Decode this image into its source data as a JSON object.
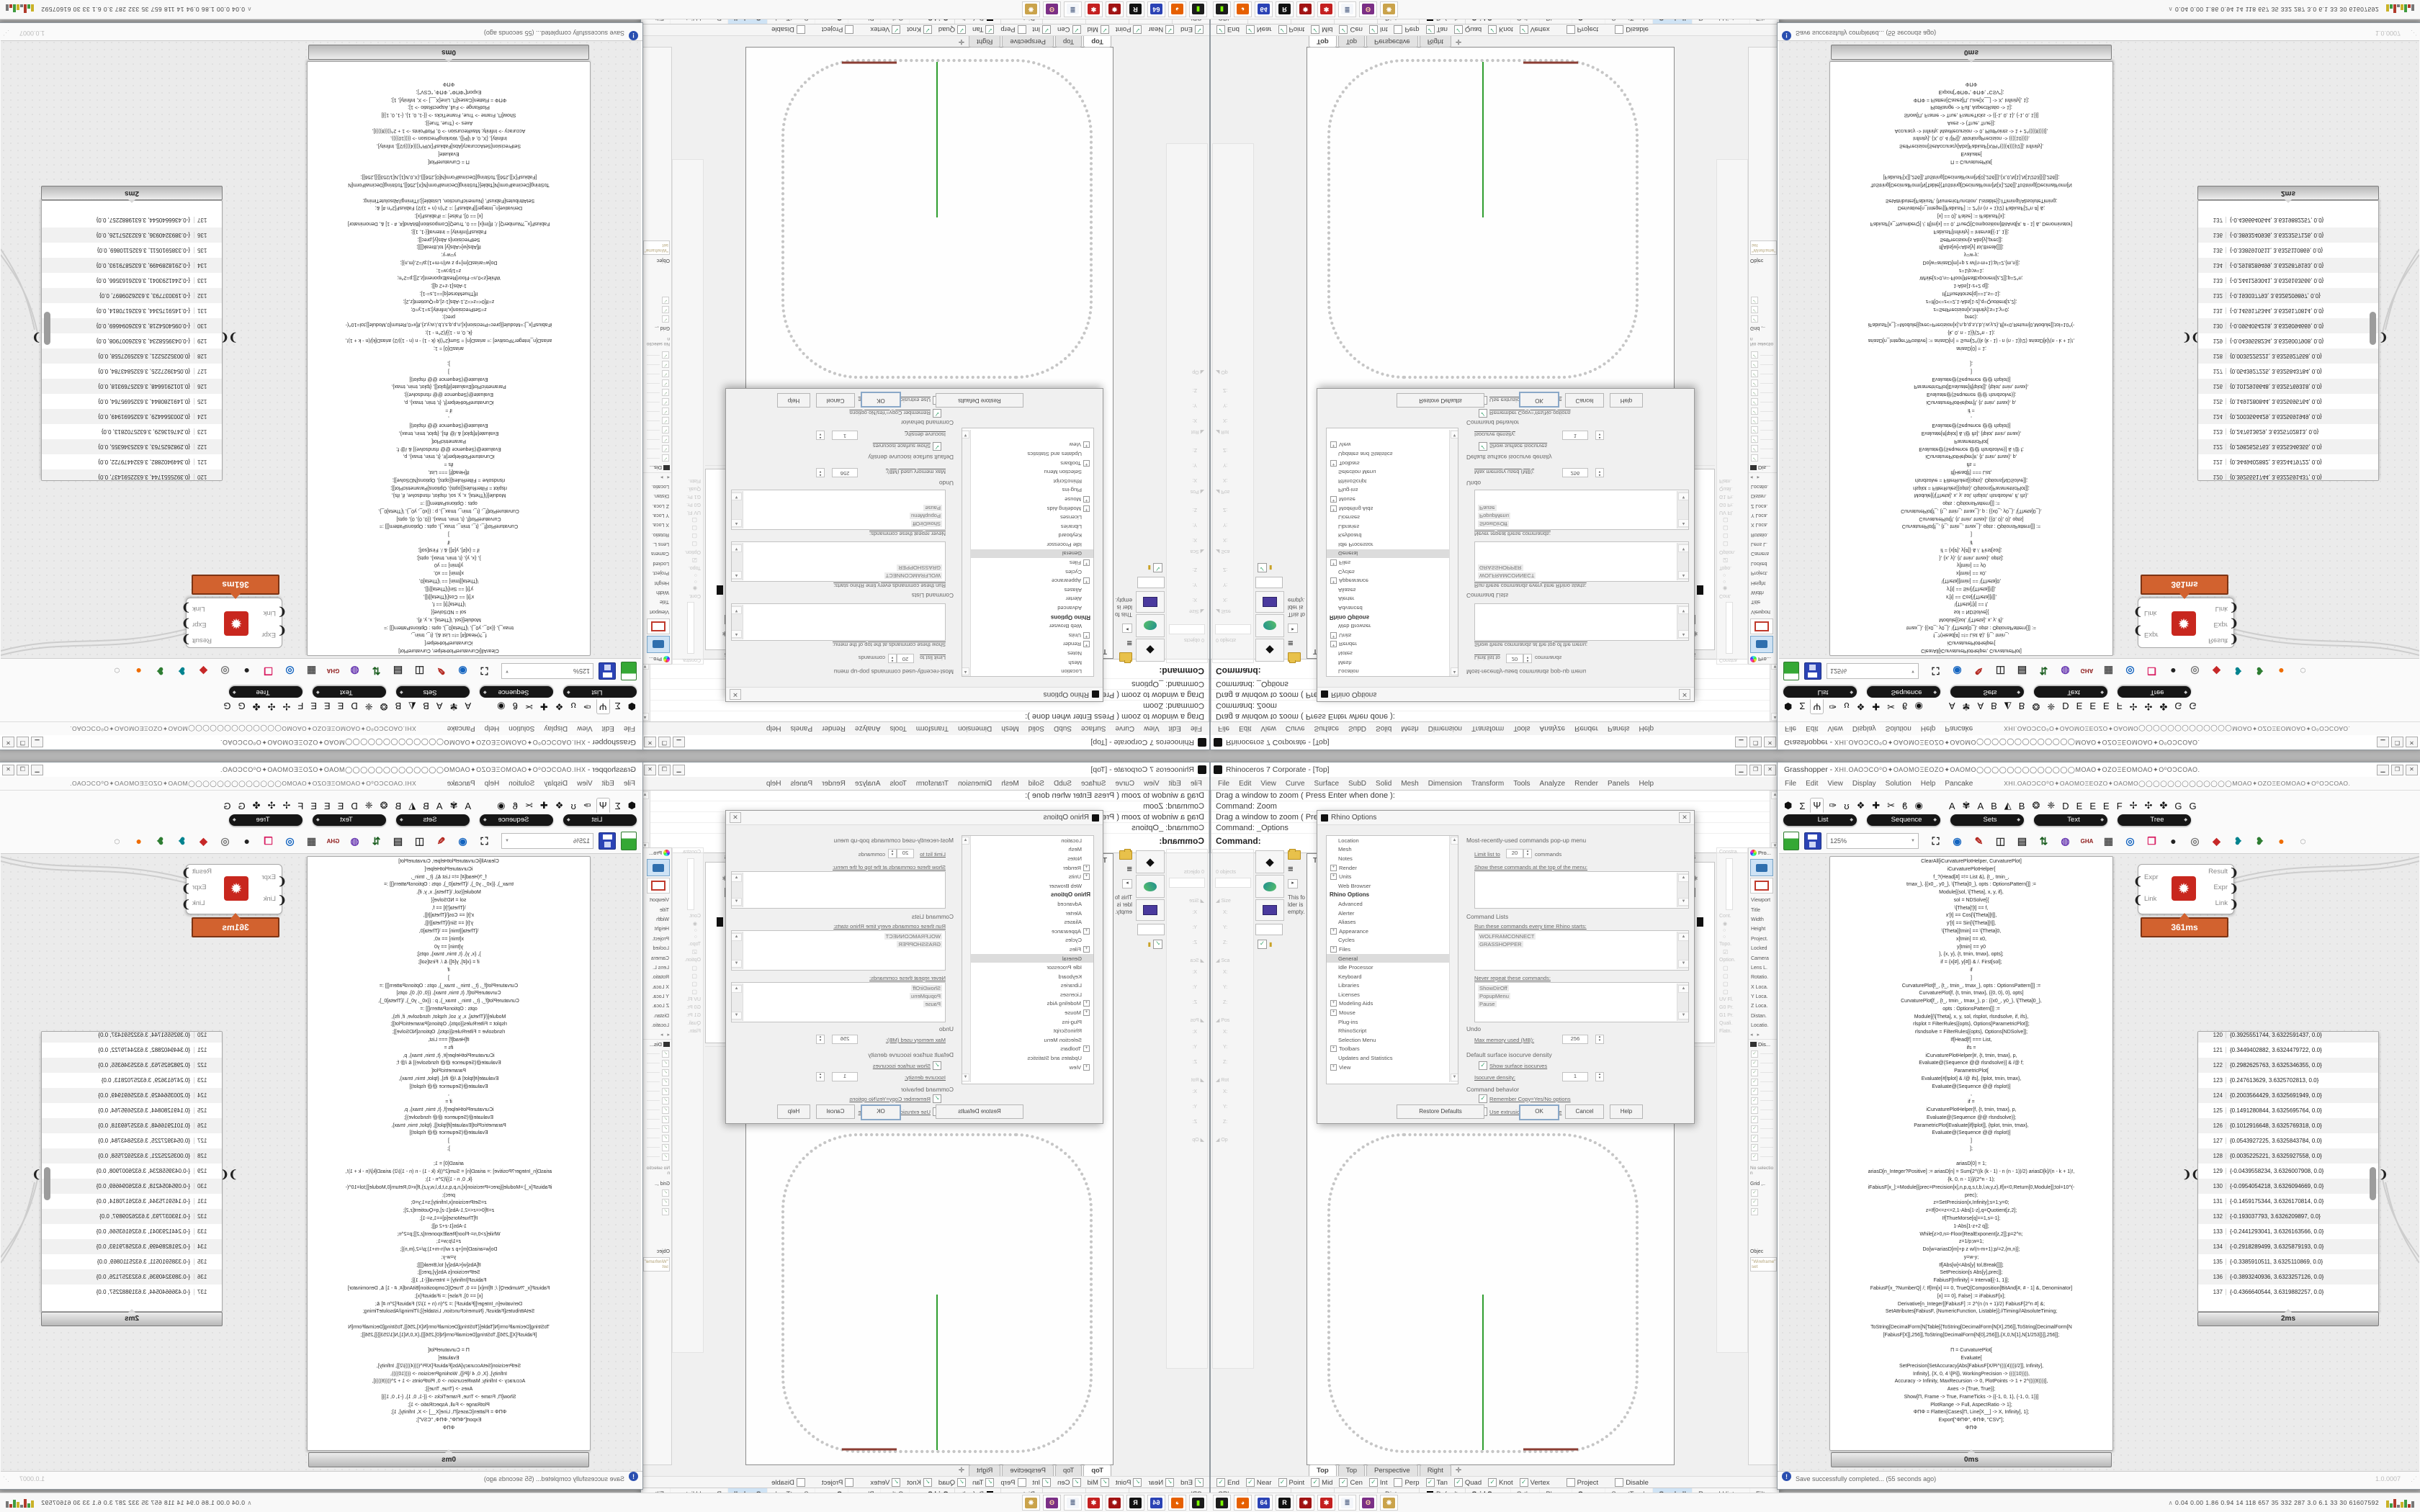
{
  "rhino": {
    "title": "Rhinoceros 7 Corporate - [Top]",
    "window_buttons": [
      "▁",
      "❐",
      "✕"
    ],
    "menu": [
      "File",
      "Edit",
      "View",
      "Curve",
      "Surface",
      "SubD",
      "Solid",
      "Mesh",
      "Dimension",
      "Transform",
      "Tools",
      "Analyze",
      "Render",
      "Panels",
      "Help"
    ],
    "command_lines": [
      "Drag a window to zoom ( Press Enter when done ):",
      "Command: Zoom",
      "Drag a window to zoom ( Press Enter when done ):",
      "Command: _Options"
    ],
    "prompt": "Command:",
    "viewport": {
      "label": "Top",
      "tabs": [
        "Top",
        "Top",
        "Perspective",
        "Right"
      ],
      "active": 0,
      "new_tab": "✛"
    },
    "osnap": [
      {
        "l": "End",
        "c": 1
      },
      {
        "l": "Near",
        "c": 1
      },
      {
        "l": "Point",
        "c": 1
      },
      {
        "l": "Mid",
        "c": 1
      },
      {
        "l": "Cen",
        "c": 1
      },
      {
        "l": "Int",
        "c": 1
      },
      {
        "l": "Perp",
        "c": 0
      },
      {
        "l": "Tan",
        "c": 1
      },
      {
        "l": "Quad",
        "c": 1
      },
      {
        "l": "Knot",
        "c": 1
      },
      {
        "l": "Vertex",
        "c": 1
      },
      {
        "l": "Project",
        "c": 0
      },
      {
        "l": "Disable",
        "c": 0
      }
    ],
    "status_fields": [
      "CPlane",
      "x",
      "y",
      "z",
      "Distance"
    ],
    "default_swatch": "Default",
    "toggles": [
      {
        "l": "Grid Snap",
        "b": 1
      },
      {
        "l": "Ortho"
      },
      {
        "l": "Planar"
      },
      {
        "l": "Osnap",
        "b": 1
      },
      {
        "l": "SmartTrack"
      },
      {
        "l": "Gumball",
        "hl": 1
      },
      {
        "l": "Record History"
      },
      {
        "l": "Filter"
      }
    ],
    "sidebar": {
      "objects": "0 objects",
      "notes": "This folder is empty.",
      "boxedit_sections": [
        "Size",
        "Sca",
        "Pos",
        "Rot"
      ],
      "axis": [
        "X:",
        "Y:",
        "Z:"
      ],
      "more": "Op"
    },
    "dock": {
      "layers_title": "Layers",
      "rcp": "RCP",
      "props_title": "Pro...",
      "display_title": "Dis...",
      "props_rows": [
        "Viewport",
        "Title",
        "Width",
        "Height",
        "Project.",
        "Locked",
        "Camera",
        "Lens L.",
        "Rotatio.",
        "X Loca.",
        "Y Loca.",
        "Z Loca.",
        "Distan.",
        "Locatio."
      ],
      "display_checks": 12,
      "no_selection": "No selectio n",
      "grid_label": "Grid ,..",
      "object_label": "Objec",
      "wireframe": "\"Wireframe\" set",
      "ghost_labels": [
        "Constra.",
        "Cont.",
        "Topo.",
        "Option.",
        "UV Fl.",
        "G0 Pr.",
        "G1 Pr.",
        "Quali.",
        "Flatn."
      ],
      "materials_note": "no materia l in this model. Click the [+] button"
    },
    "options": {
      "title": "Rhino Options",
      "tree": [
        {
          "l": "Location"
        },
        {
          "l": "Mesh"
        },
        {
          "l": "Notes"
        },
        {
          "l": "Render",
          "p": 1
        },
        {
          "l": "Units",
          "p": 1
        },
        {
          "l": "Web Browser"
        },
        {
          "l": "Rhino Options",
          "h": 1
        },
        {
          "l": "Advanced"
        },
        {
          "l": "Alerter"
        },
        {
          "l": "Aliases"
        },
        {
          "l": "Appearance",
          "p": 1
        },
        {
          "l": "Cycles"
        },
        {
          "l": "Files",
          "p": 1
        },
        {
          "l": "General",
          "s": 1
        },
        {
          "l": "Idle Processor"
        },
        {
          "l": "Keyboard"
        },
        {
          "l": "Libraries"
        },
        {
          "l": "Licenses"
        },
        {
          "l": "Modeling Aids",
          "p": 1
        },
        {
          "l": "Mouse",
          "p": 1
        },
        {
          "l": "Plug-ins"
        },
        {
          "l": "RhinoScript"
        },
        {
          "l": "Selection Menu"
        },
        {
          "l": "Toolbars",
          "p": 1
        },
        {
          "l": "Updates and Statistics"
        },
        {
          "l": "View",
          "p": 1
        }
      ],
      "mru_title": "Most-recently-used commands pop-up menu",
      "limit_pre": "Limit list to",
      "limit_value": "20",
      "limit_post": "commands",
      "show_top": "Show these commands at the top of the menu:",
      "cmd_lists_title": "Command Lists",
      "run_label": "Run these commands every time Rhino starts:",
      "run_items": [
        "WOLFRAMCONNECT",
        "GRASSHOPPER"
      ],
      "never_label": "Never repeat these commands:",
      "never_items": [
        "ShowDirOff",
        "PopupMenu",
        "Pause"
      ],
      "undo_title": "Undo",
      "mem_label": "Max memory used (MB):",
      "mem_value": "256",
      "iso_title": "Default surface isocurve density",
      "iso_check": "Show surface isocurves",
      "iso_density_label": "Isocurve density:",
      "iso_density_value": "1",
      "behavior_title": "Command behavior",
      "behavior_items": [
        "Remember Copy=Yes/No options",
        "Use extrusions when possible"
      ],
      "buttons": [
        "Restore Defaults",
        "OK",
        "Cancel",
        "Help"
      ]
    }
  },
  "gh": {
    "title_prefix": "Grasshopper - ",
    "title_symbols": "ΧΗΙ.ΟΑΟϽCΟ⁰Ο✦ΟΑΟΜΟΞΕΟΖΟ✦ΟΑΟΜΟ◯◯◯◯◯◯◯◯◯◯◯◯◯ΜΟΑΟ✦ΟΖΟΞΕΟΜΟΑΟ✦Ο⁰ΟϽCΟΑΟ.",
    "window_buttons": [
      "▁",
      "❐",
      "✕"
    ],
    "menu": [
      "File",
      "Edit",
      "View",
      "Display",
      "Solution",
      "Help",
      "Pancake"
    ],
    "tab_glyphs": [
      "⬢",
      "Σ",
      "Ψ",
      "✑",
      "ʊ",
      "❖",
      "✚",
      "✂",
      "ϐ",
      "◉",
      "A",
      "✾",
      "A",
      "B",
      "◭",
      "B",
      "❂",
      "❈",
      "D",
      "E",
      "E",
      "E",
      "F",
      "✢",
      "✣",
      "✤",
      "G",
      "G"
    ],
    "selected_tab": 2,
    "pills": [
      "List",
      "Sequence",
      "Sets",
      "Text",
      "Tree"
    ],
    "zoom": "125%",
    "toolbar": [
      {
        "g": "⛶",
        "c": "#111"
      },
      {
        "g": "◉",
        "c": "#1565c0"
      },
      {
        "g": "✎",
        "c": "#b3261e"
      },
      {
        "g": "◫",
        "c": "#333"
      },
      {
        "g": "▤",
        "c": "#333"
      },
      {
        "g": "⇅",
        "c": "#1b5e20"
      },
      {
        "g": "◍",
        "c": "#6a3ab2"
      },
      {
        "g": "GHA",
        "c": "#8e1b1b"
      },
      {
        "g": "▦",
        "c": "#555"
      },
      {
        "g": "◎",
        "c": "#1565c0"
      },
      {
        "g": "❒",
        "c": "#d81b60"
      },
      {
        "g": "●",
        "c": "#222"
      },
      {
        "g": "◎",
        "c": "#777"
      },
      {
        "g": "◆",
        "c": "#c62828"
      },
      {
        "g": "❥",
        "c": "#00838f"
      },
      {
        "g": "❥",
        "c": "#2e7d32"
      },
      {
        "g": "●",
        "c": "#ef6c00"
      },
      {
        "g": "◌",
        "c": "#555"
      }
    ],
    "component": {
      "inputs": [
        "Expr",
        "Link"
      ],
      "outputs": [
        "Result",
        "Expr",
        "Link"
      ],
      "time": "361ms"
    },
    "code_time": "0ms",
    "list": {
      "time": "2ms",
      "items": [
        [
          120,
          "{0.3925551744, 3.6322591437, 0.0}"
        ],
        [
          121,
          "{0.3449402882, 3.6324479722, 0.0}"
        ],
        [
          122,
          "{0.2982625763, 3.6325346355, 0.0}"
        ],
        [
          123,
          "{0.247613629, 3.6325702813, 0.0}"
        ],
        [
          124,
          "{0.2003564429, 3.6325691949, 0.0}"
        ],
        [
          125,
          "{0.1491280844, 3.6325695764, 0.0}"
        ],
        [
          126,
          "{0.1012916648, 3.6325769318, 0.0}"
        ],
        [
          127,
          "{0.0543927225, 3.6325843784, 0.0}"
        ],
        [
          128,
          "{0.0035225221, 3.6325927558, 0.0}"
        ],
        [
          129,
          "{-0.0439558234, 3.6326007908, 0.0}"
        ],
        [
          130,
          "{-0.0954054218, 3.6326094669, 0.0}"
        ],
        [
          131,
          "{-0.1459175344, 3.6326170814, 0.0}"
        ],
        [
          132,
          "{-0.193037793, 3.6326209897, 0.0}"
        ],
        [
          133,
          "{-0.2441293041, 3.6326163566, 0.0}"
        ],
        [
          134,
          "{-0.2918289499, 3.6325879193, 0.0}"
        ],
        [
          135,
          "{-0.3385910511, 3.6325110869, 0.0}"
        ],
        [
          136,
          "{-0.3893240936, 3.6323257126, 0.0}"
        ],
        [
          137,
          "{-0.4366640544, 3.6319882257, 0.0}"
        ]
      ]
    },
    "status": {
      "msg": "Save successfully completed... (55 seconds ago)",
      "version": "1.0.0007"
    },
    "code_lines": [
      "ClearAll[iCurvaturePlotHelper, CurvaturePlot]",
      "iCurvaturePlotHelper[",
      "f_?(Head[#] =!= List &), {t_, tmin_,",
      "tmax_}, {{x0_, y0_}, \\[Theta]0_}, opts : OptionsPattern[]] :=",
      "Module[{sol, \\[Theta], x, y, if},",
      "sol = NDSolve[{",
      "\\[Theta]'[t] == f,",
      "x'[t] == Cos[\\[Theta][t]],",
      "y'[t] == Sin[\\[Theta][t]],",
      "\\[Theta][tmin] == \\[Theta]0,",
      "x[tmin] == x0,",
      "y[tmin] == y0",
      "}, {x, y}, {t, tmin, tmax}, opts];",
      "if = {x[#], y[#]} & /. First[sol];",
      "if",
      "]",
      "CurvaturePlot[f_, {t_, tmin_, tmax_}, opts : OptionsPattern[]] :=",
      "CurvaturePlot[f, {t, tmin, tmax}, {{0, 0}, 0}, opts]",
      "CurvaturePlot[f_, {t_, tmin_, tmax_}, p : {{x0_, y0_}, \\[Theta]0_},",
      "opts : OptionsPattern[]] :=",
      "Module[{\\[Theta], x, y, sol, rlsplot, rlsndsolve, if, ifs},",
      "rlsplot = FilterRules[{opts}, Options[ParametricPlot]];",
      "rlsndsolve = FilterRules[{opts}, Options[NDSolve]];",
      "If[Head[f] === List,",
      "ifs =",
      "iCurvaturePlotHelper[#, {t, tmin, tmax}, p,",
      "Evaluate@(Sequence @@ rlsndsolve)] & /@ f;",
      "ParametricPlot[",
      "Evaluate[#[tplot] & /@ ifs], {tplot, tmin, tmax},",
      "Evaluate@(Sequence @@ rlsplot)]",
      ",",
      "if =",
      "iCurvaturePlotHelper[f, {t, tmin, tmax}, p,",
      "Evaluate@(Sequence @@ rlsndsolve)];",
      "ParametricPlot[Evaluate[if[tplot]], {tplot, tmin, tmax},",
      "Evaluate@(Sequence @@ rlsplot)]",
      "]",
      "];",
      "",
      "ariasD[0] = 1;",
      "ariasD[n_Integer?Positive] := ariasD[n] = Sum[2^((k (k - 1) - n (n - 1))/2) ariasD[k]/(n - k + 1)!,",
      "{k, 0, n - 1}]/(2^n - 1);",
      "iFabiusF[x_]:=Module[{prec=Precision[x],n,p,q,s,t,b,l,w,y,z},If[x<0,Return[0,Module]];tol=10^(-",
      "prec);",
      "z=SetPrecision[x,Infinity];s=1;y=0;",
      "z=If[0<=z<=2,1-Abs[1-z],q=Quotient[z,2];",
      "If[ThueMorse[q]==1,s=-1];",
      "1-Abs[1-z+2 q]];",
      "While[z>0,n=-Floor[RealExponent[z,2]];p=2^n;",
      "z=1/p;w=1;",
      "Do[w=ariasD[m]+p z w/(n-m+1);p/=2,{m,n}];",
      "y=w-y;",
      "If[Abs[w]<Abs[y] tol,Break[]]];",
      "SetPrecision[s Abs[y],prec]];",
      "FabiusF[Infinity] = Interval[{-1, 1}];",
      "FabiusF[x_?NumberQ] /; If[Im[x] == 0, TrueQ[Composition[BitAnd[#, # - 1] &, Denominator]",
      "[x] == 0], False] := iFabiusF[x];",
      "Derivative[n_Integer][FabiusF] := 2^(n (n + 1)/2) FabiusF[2^n #] &;",
      "SetAttributes[FabiusF, {NumericFunction, Listable}];//Timing//AbsoluteTiming;",
      "",
      "ToString[DecimalForm[N[Table[{ToString[DecimalForm[N[X],256]],ToString[DecimalForm[N",
      "[FabiusF[X]],256]],ToString[DecimalForm[N[0],256]]},{X,0,N[1],N[1/253]}]],256]];",
      "",
      "Π = CurvaturePlot[",
      "Evaluate[",
      "SetPrecision[SetAccuracy[Abs[FabiusF[X/Pi^((((4))))/2]], Infinity],",
      "Infinity], {X, 0, 4 \\[Pi]}, WorkingPrecision -> ((((10)))),",
      "Accuracy -> Infinity, MaxRecursion -> 0, PlotPoints -> 1 + 2^((((8))))],",
      "Axes -> {True, True}];",
      "Show[Π, Frame -> True, FrameTicks -> {{-1, 0, 1}, {-1, 0, 1}}]",
      "PlotRange -> Full, AspectRatio -> 1];",
      "ΦΠΦ = Flatten[Cases[Π, Line[X__] -> X, Infinity], 1];",
      "Export[\"ΦΠΦ\", ΦΠΦ, \"CSV\"];",
      "ΦΠΦ"
    ]
  },
  "taskbar": {
    "stats": "0.04 0.00 1.86 0.94   14   118 657   35   332 287   3.0   6.1   33   30   61607592",
    "icons": [
      {
        "name": "console-icon",
        "g": "▮",
        "fg": "#7CFC00",
        "bg": "#1c1c1c"
      },
      {
        "name": "firefox-icon",
        "g": "◕",
        "fg": "#fff",
        "bg": "#e66000"
      },
      {
        "name": "floppy64-icon",
        "g": "64",
        "fg": "#fff",
        "bg": "#2b43b5"
      },
      {
        "name": "rhino-icon",
        "g": "R",
        "fg": "#fff",
        "bg": "#111"
      },
      {
        "name": "red-badge-icon",
        "g": "✹",
        "fg": "#fff",
        "bg": "#a11212"
      },
      {
        "name": "red-gear-icon",
        "g": "✱",
        "fg": "#fff",
        "bg": "#c42020"
      },
      {
        "name": "notepad-icon",
        "g": "≣",
        "fg": "#5a6b8c",
        "bg": "#f4f6fa"
      },
      {
        "name": "purple-app-icon",
        "g": "ʘ",
        "fg": "#ffd9a0",
        "bg": "#7b2f86"
      },
      {
        "name": "palette-icon",
        "g": "❋",
        "fg": "#fff",
        "bg": "#caa34b"
      }
    ],
    "graph_colors": [
      "#c9b227",
      "#3f9b3f",
      "#b23a2a",
      "#777"
    ]
  },
  "colors": {
    "accent_orange": "#d2622f",
    "axis_green": "#2f9e2f",
    "axis_red": "#8b3d33",
    "dots": "#c6c6c6",
    "gumball_hl": "#cfe3f5"
  }
}
